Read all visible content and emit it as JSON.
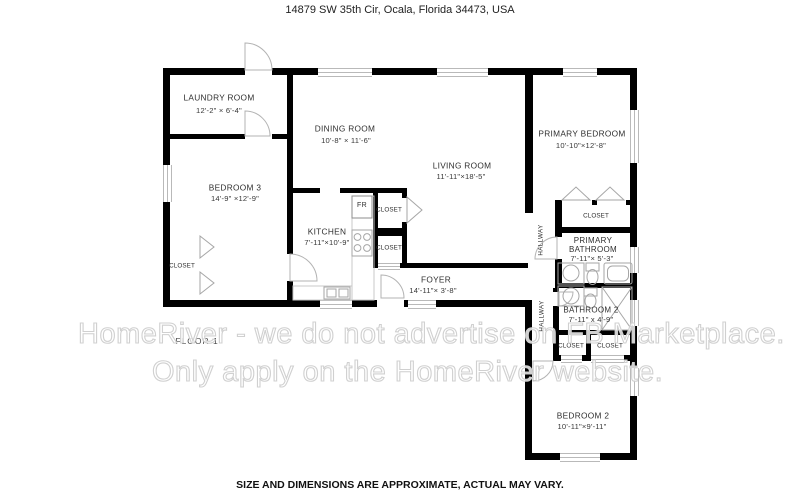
{
  "title": "14879 SW 35th Cir, Ocala, Florida 34473, USA",
  "floor_label": "FLOOR 1",
  "disclaimer": "SIZE AND DIMENSIONS ARE APPROXIMATE, ACTUAL MAY VARY.",
  "watermark": {
    "line1": "HomeRiver - we do not advertise on FB Marketplace.",
    "line2": "Only apply on the HomeRiver website."
  },
  "rooms": {
    "laundry": {
      "name": "LAUNDRY ROOM",
      "dims": "12'-2\" × 6'-4\""
    },
    "bedroom3": {
      "name": "BEDROOM 3",
      "dims": "14'-9\" ×12'-9\""
    },
    "dining": {
      "name": "DINING ROOM",
      "dims": "10'-8\" × 11'-6\""
    },
    "living": {
      "name": "LIVING ROOM",
      "dims": "11'-11\"×18'-5\""
    },
    "kitchen": {
      "name": "KITCHEN",
      "dims": "7'-11\"×10'-9\""
    },
    "foyer": {
      "name": "FOYER",
      "dims": "14'-11\"× 3'-8\""
    },
    "primary_bedroom": {
      "name": "PRIMARY BEDROOM",
      "dims": "10'-10\"×12'-8\""
    },
    "primary_bathroom": {
      "name": "PRIMARY BATHROOM",
      "dims": "7'-11\"× 5'-3\""
    },
    "bathroom2": {
      "name": "BATHROOM 2",
      "dims": "7'-11\" x 4'-9\""
    },
    "bedroom2": {
      "name": "BEDROOM 2",
      "dims": "10'-11\"×9'-11\""
    }
  },
  "labels": {
    "closet": "CLOSET",
    "hallway": "HALLWAY",
    "fridge": "FR"
  },
  "colors": {
    "wall": "#000000",
    "fixture_stroke": "#a6a6a6",
    "watermark_stroke": "#d0d0d0"
  }
}
